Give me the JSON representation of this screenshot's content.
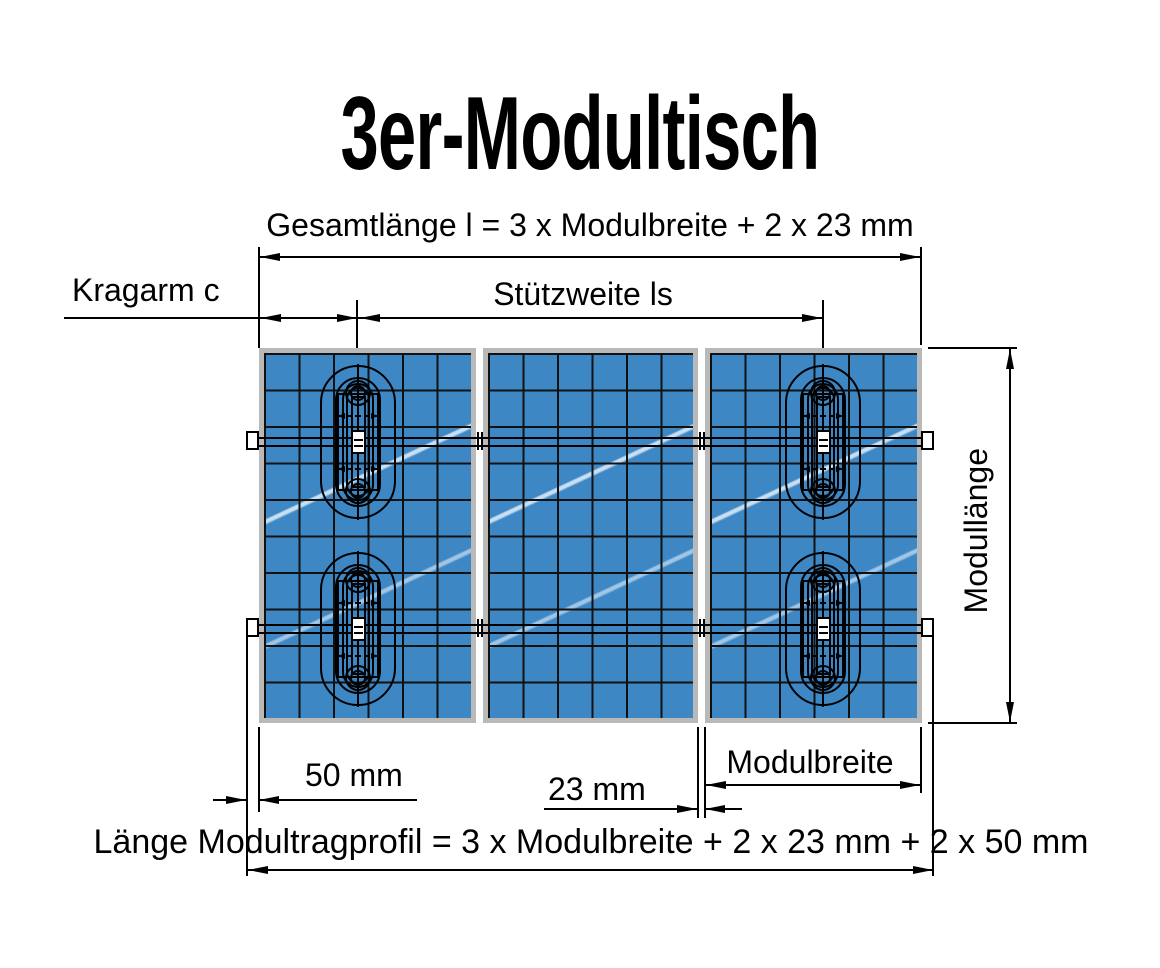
{
  "title": "3er-Modultisch",
  "labels": {
    "gesamtlaenge": "Gesamtlänge l = 3 x Modulbreite + 2 x 23 mm",
    "kragarm": "Kragarm c",
    "stuetzweite": "Stützweite ls",
    "modullaenge": "Modullänge",
    "rail_overhang": "50 mm",
    "module_gap": "23 mm",
    "modulbreite": "Modulbreite",
    "tragprofil": "Länge Modultragprofil = 3 x Modulbreite + 2 x 23 mm + 2 x 50 mm"
  },
  "colors": {
    "module_blue": "#3e87c5",
    "module_frame_gray": "#b9b9b9",
    "line_black": "#000000",
    "background_white": "#ffffff"
  },
  "structure": {
    "module_count": 3,
    "cells_per_module_columns": 6,
    "cells_per_module_rows": 10,
    "support_rail_count": 2,
    "clamp_count": 4
  }
}
